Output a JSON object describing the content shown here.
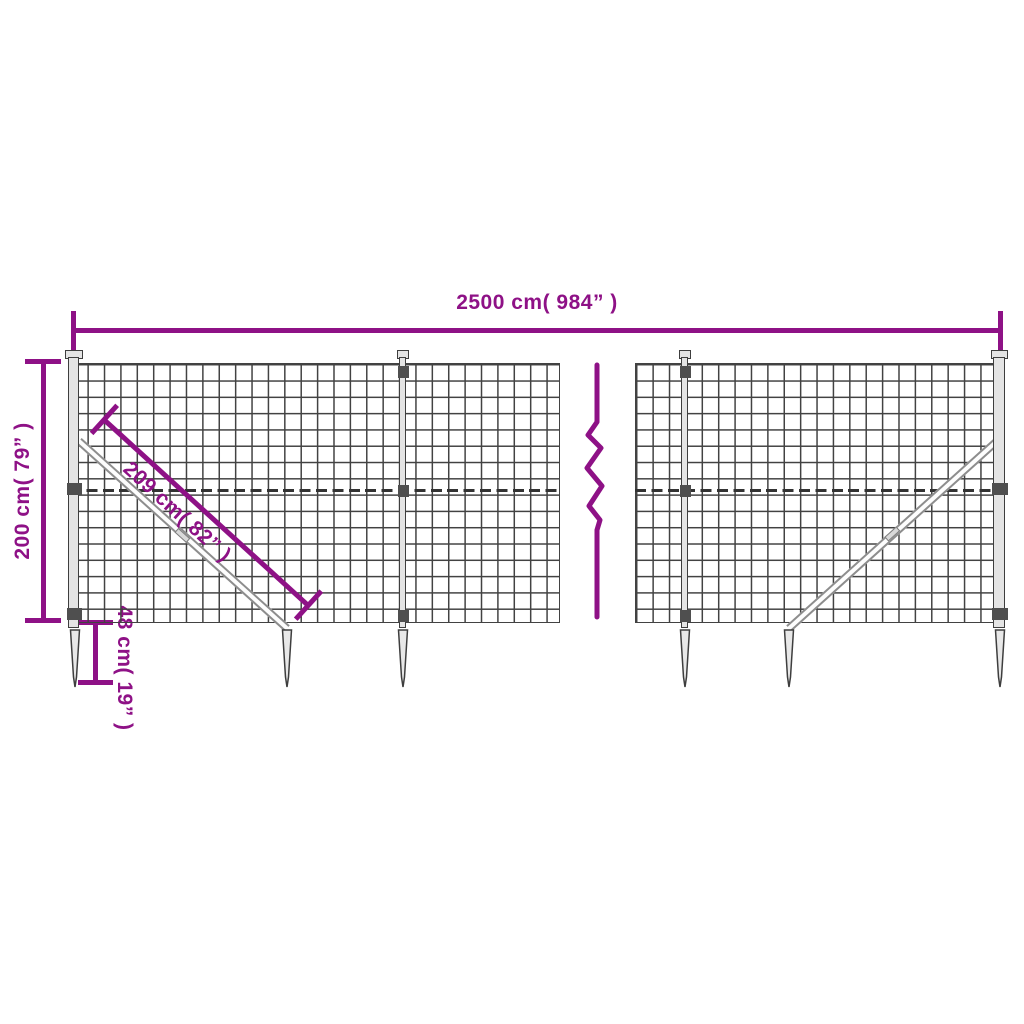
{
  "diagram_type": "product-dimension-diagram",
  "subject": "wire-mesh-fence-with-ground-anchor-spikes",
  "colors": {
    "accent": "#8e1186",
    "mesh_line": "#424242",
    "steel_fill": "#e4e4e4",
    "steel_stroke": "#3e3e3e",
    "brace_stroke": "#8d8d8d"
  },
  "dimensions": {
    "total_width": {
      "label": "2500 cm( 984” )"
    },
    "fence_height": {
      "label": "200 cm( 79” )"
    },
    "brace_length": {
      "label": "209 cm( 82” )"
    },
    "spike_length": {
      "label": "48 cm( 19” )"
    }
  },
  "icons": {
    "break_symbol": "zigzag-break-line-icon"
  }
}
